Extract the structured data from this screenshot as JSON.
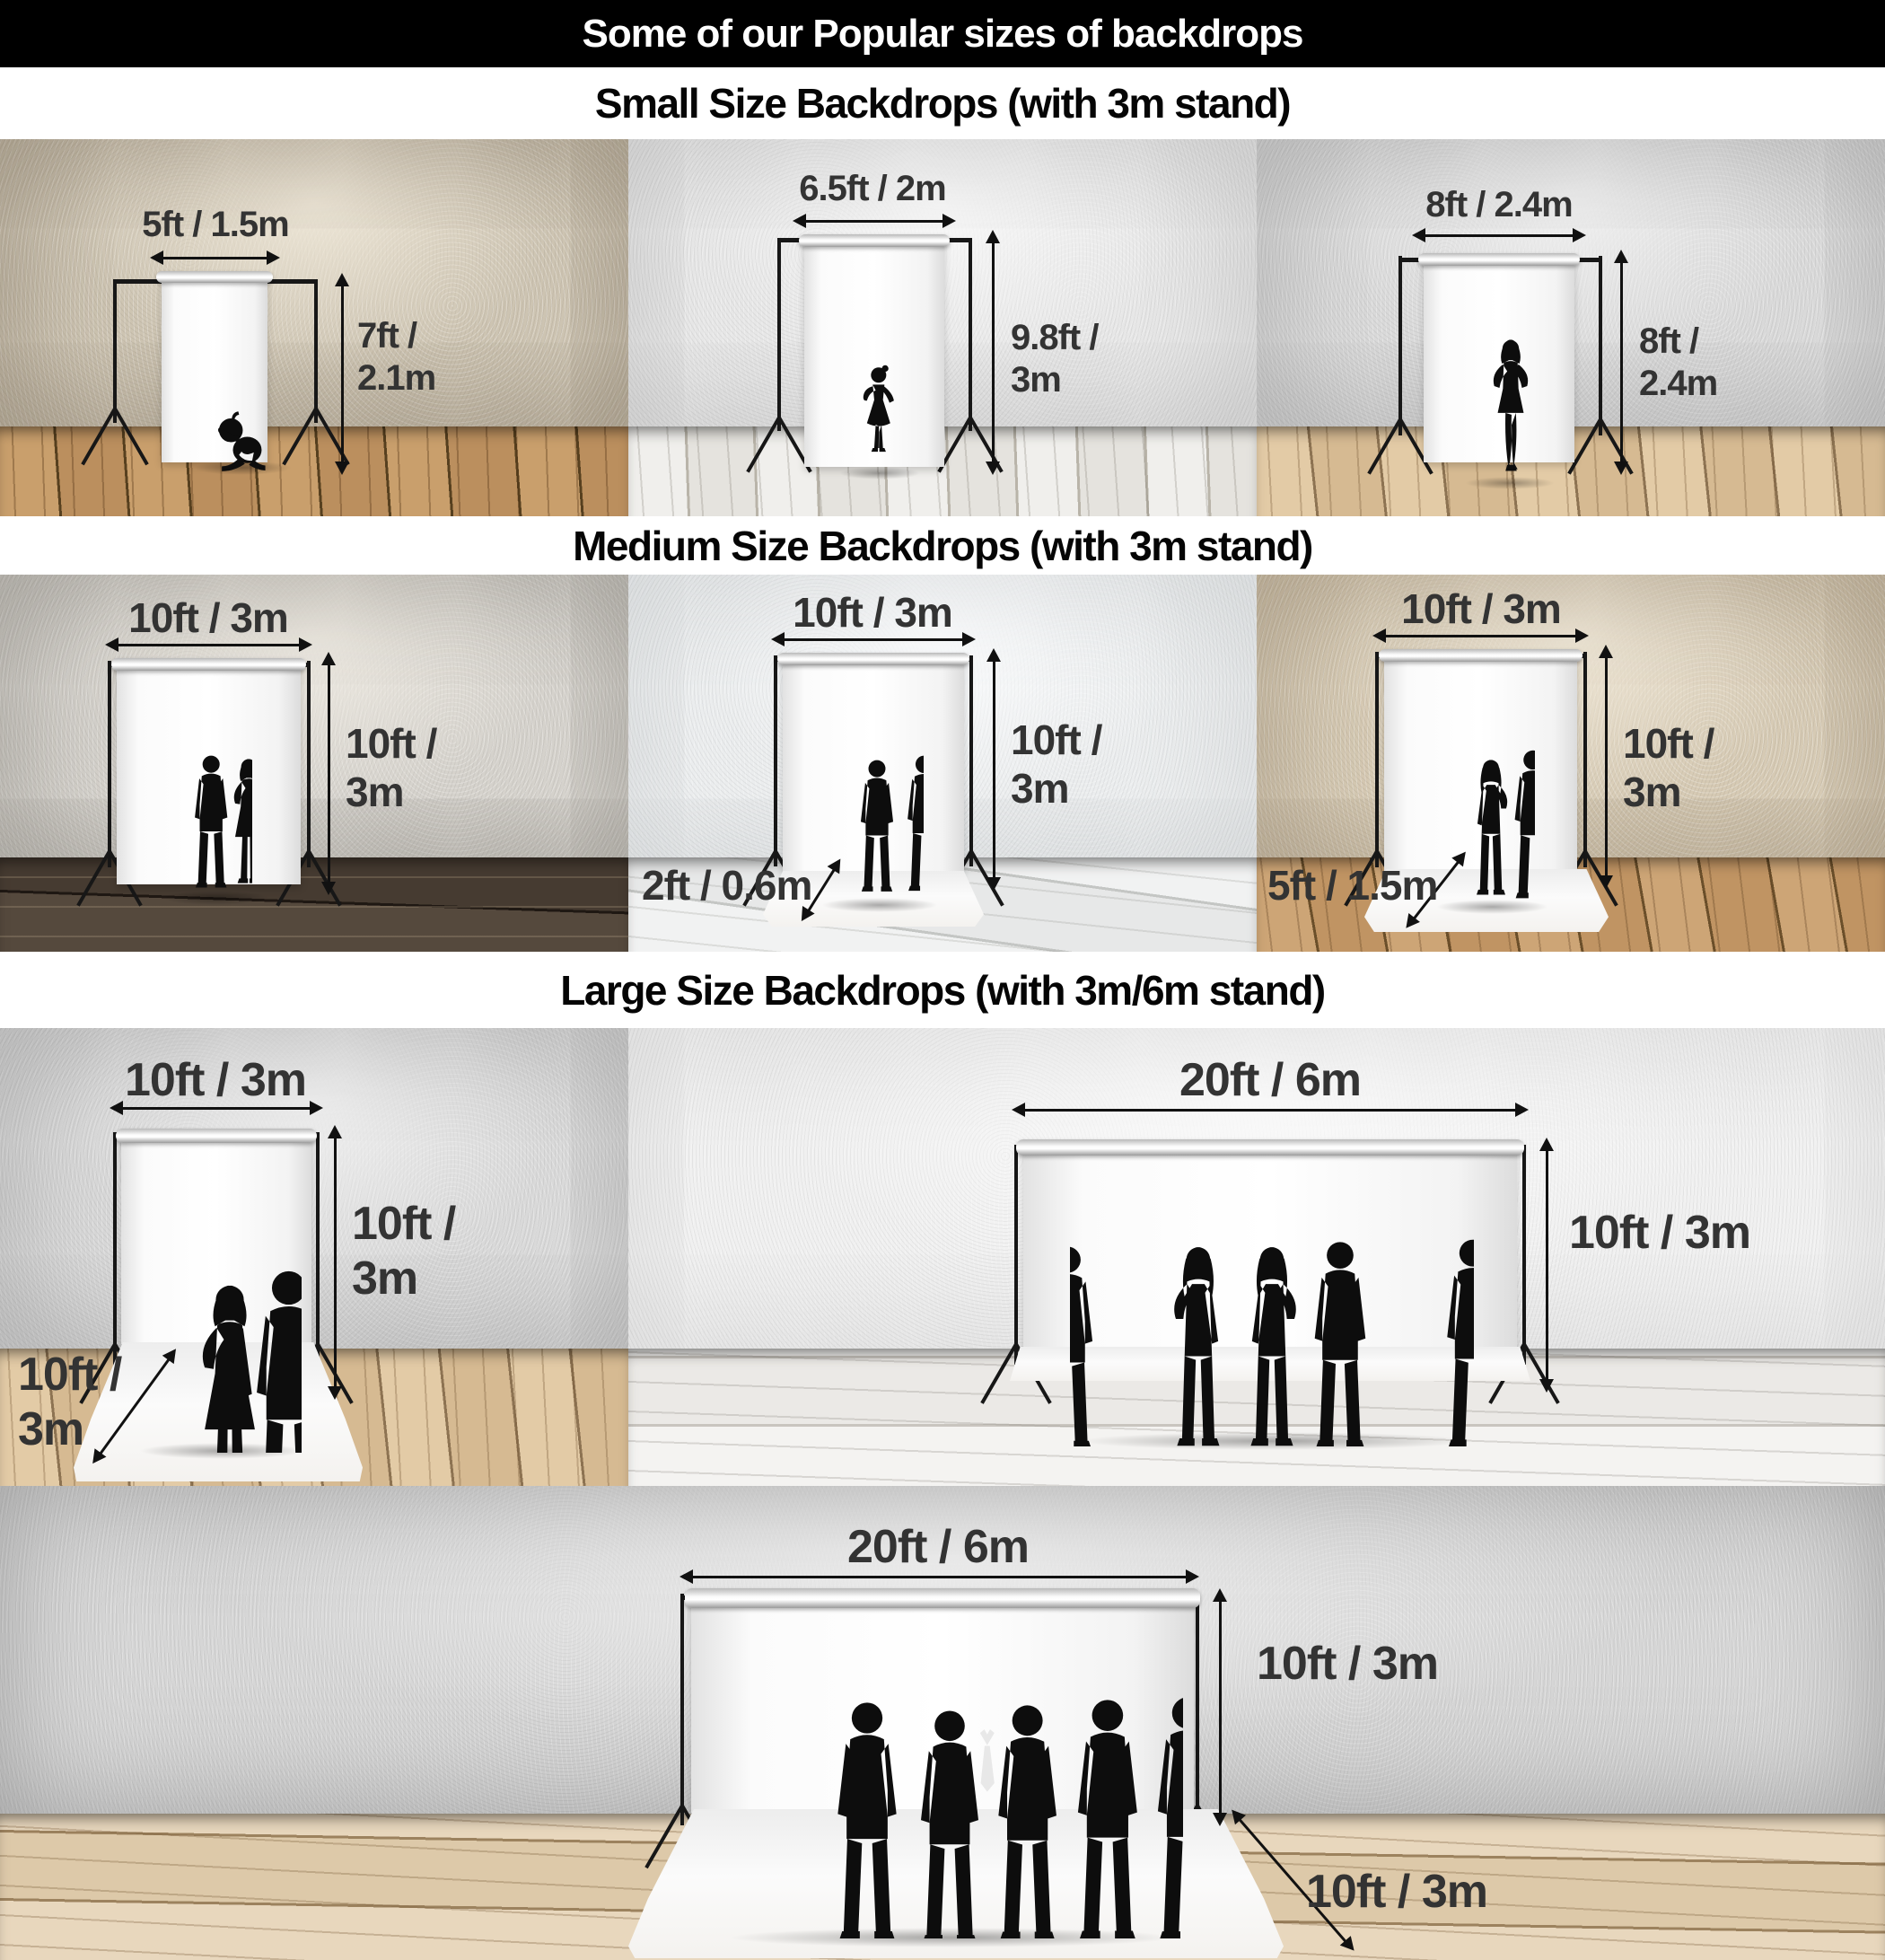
{
  "theme": {
    "header_bg": "#000000",
    "header_text_color": "#ffffff",
    "section_title_color": "#050505",
    "dimension_label_color": "#333333",
    "arrow_color": "#111111",
    "silhouette_color": "#0d0d0d",
    "backdrop_color": "#fafafa"
  },
  "header": {
    "title": "Some of our Popular sizes of backdrops"
  },
  "sections": [
    {
      "title": "Small Size Backdrops (with 3m stand)",
      "panels": [
        {
          "width_label": "5ft / 1.5m",
          "height_label": "7ft / 2.1m",
          "figure": "sitting-baby-silhouette"
        },
        {
          "width_label": "6.5ft / 2m",
          "height_label": "9.8ft / 3m",
          "figure": "young-girl-silhouette"
        },
        {
          "width_label": "8ft / 2.4m",
          "height_label": "8ft / 2.4m",
          "figure": "posing-woman-silhouette"
        }
      ]
    },
    {
      "title": "Medium Size Backdrops (with 3m stand)",
      "panels": [
        {
          "width_label": "10ft / 3m",
          "height_label": "10ft / 3m",
          "figure": "couple-silhouette"
        },
        {
          "width_label": "10ft / 3m",
          "height_label": "10ft / 3m",
          "floor_label": "2ft / 0.6m",
          "figure": "two-men-silhouette"
        },
        {
          "width_label": "10ft / 3m",
          "height_label": "10ft / 3m",
          "floor_label": "5ft / 1.5m",
          "figure": "couple-silhouette"
        }
      ]
    },
    {
      "title": "Large Size Backdrops (with 3m/6m stand)",
      "panels": [
        {
          "width_label": "10ft / 3m",
          "height_label": "10ft / 3m",
          "floor_label": "10ft / 3m",
          "figure": "three-business-people-silhouette"
        },
        {
          "width_label": "20ft / 6m",
          "height_label": "10ft / 3m",
          "figure": "six-people-silhouette"
        },
        {
          "width_label": "20ft / 6m",
          "height_label": "10ft / 3m",
          "floor_label": "10ft / 3m",
          "figure": "six-men-silhouette"
        }
      ]
    }
  ]
}
